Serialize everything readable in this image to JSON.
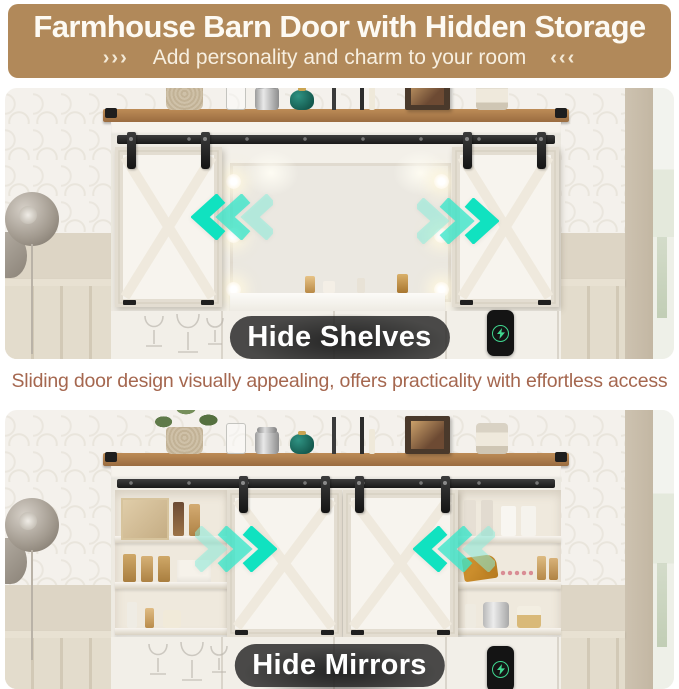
{
  "header": {
    "title": "Farmhouse Barn Door with Hidden Storage",
    "subtitle": "Add personality and charm to your room",
    "arrows_left": "›››",
    "arrows_right": "‹‹‹",
    "bg_color": "#b1895a",
    "text_color": "#fdfaf3"
  },
  "caption": {
    "text": "Sliding door design visually appealing, offers practicality with effortless access",
    "color": "#a5674f"
  },
  "photos": [
    {
      "label": "Hide Shelves",
      "description": "Barn doors slid outward covering side shelves, vanity mirror with lights revealed",
      "arrow_left_group_direction": "left",
      "arrow_right_group_direction": "right"
    },
    {
      "label": "Hide Mirrors",
      "description": "Barn doors slid to center covering mirror, side storage shelves revealed",
      "arrow_left_group_direction": "right",
      "arrow_right_group_direction": "left"
    }
  ],
  "colors": {
    "accent_teal": "#14e2c2",
    "banner_brown": "#b1895a",
    "caption_terracotta": "#a5674f",
    "wood_top": "#a97a4a",
    "pill_dark": "#242424",
    "charger_green": "#3fd68f"
  },
  "icons": {
    "chevron_group": "triple-chevron-arrow",
    "lightning": "charging-bolt",
    "wall_lamp": "sconce-lamp"
  }
}
